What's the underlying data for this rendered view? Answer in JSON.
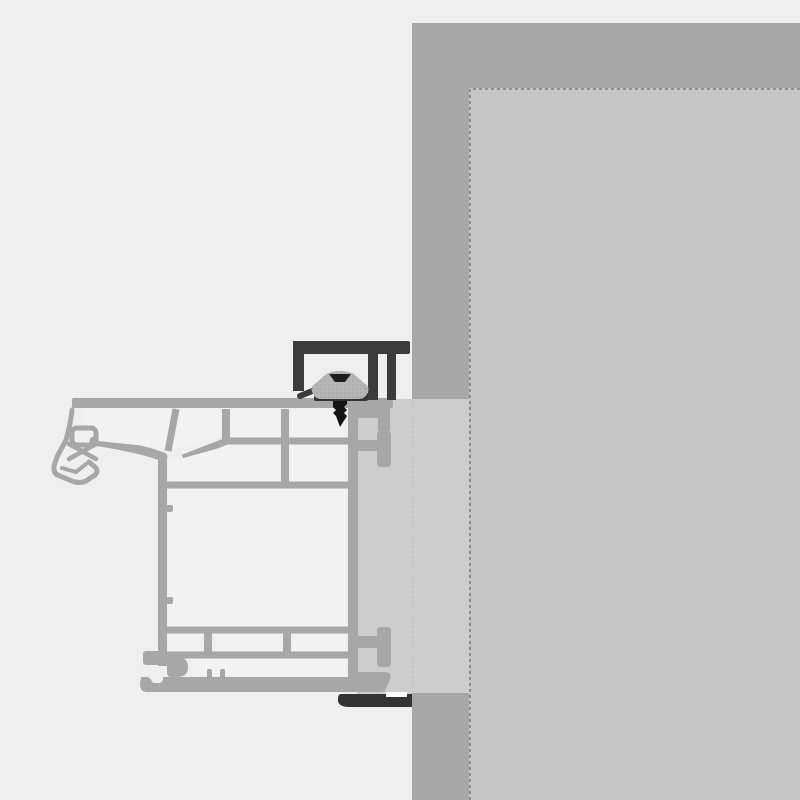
{
  "diagram": {
    "kind": "window-installation-cross-section",
    "text_labels": []
  },
  "colors": {
    "background": "#efefef",
    "wall_outer": "#a7a7a7",
    "wall_inner": "#c6c6c6",
    "wall_inner_edge": "#8d8d8d",
    "joint_filler": "#cdcdcd",
    "joint_filler_line": "#c2c2c2",
    "profile_line": "#a7a7a7",
    "profile_cell": "#f2f2f2",
    "bracket_dark": "#3b3b3b",
    "clamp_body": "#b6b6b6",
    "clamp_dot": "#9e9e9e",
    "clamp_base": "#333333",
    "clamp_notch": "#1f1f1f",
    "screw": "#141414",
    "sill_flashing": "#343434",
    "flashing_gap": "#fdfdfd"
  },
  "parts": {
    "wall_outer": "masonry-wall-outer-layer",
    "wall_inner": "masonry-wall-inner-layer",
    "joint_filler": "installation-joint-filler",
    "frame_profile": "window-frame-profile-section",
    "bracket": "mounting-bracket",
    "clamp": "anchor-clamp",
    "screw": "fastening-screw",
    "flashing": "sill-end-flashing"
  }
}
